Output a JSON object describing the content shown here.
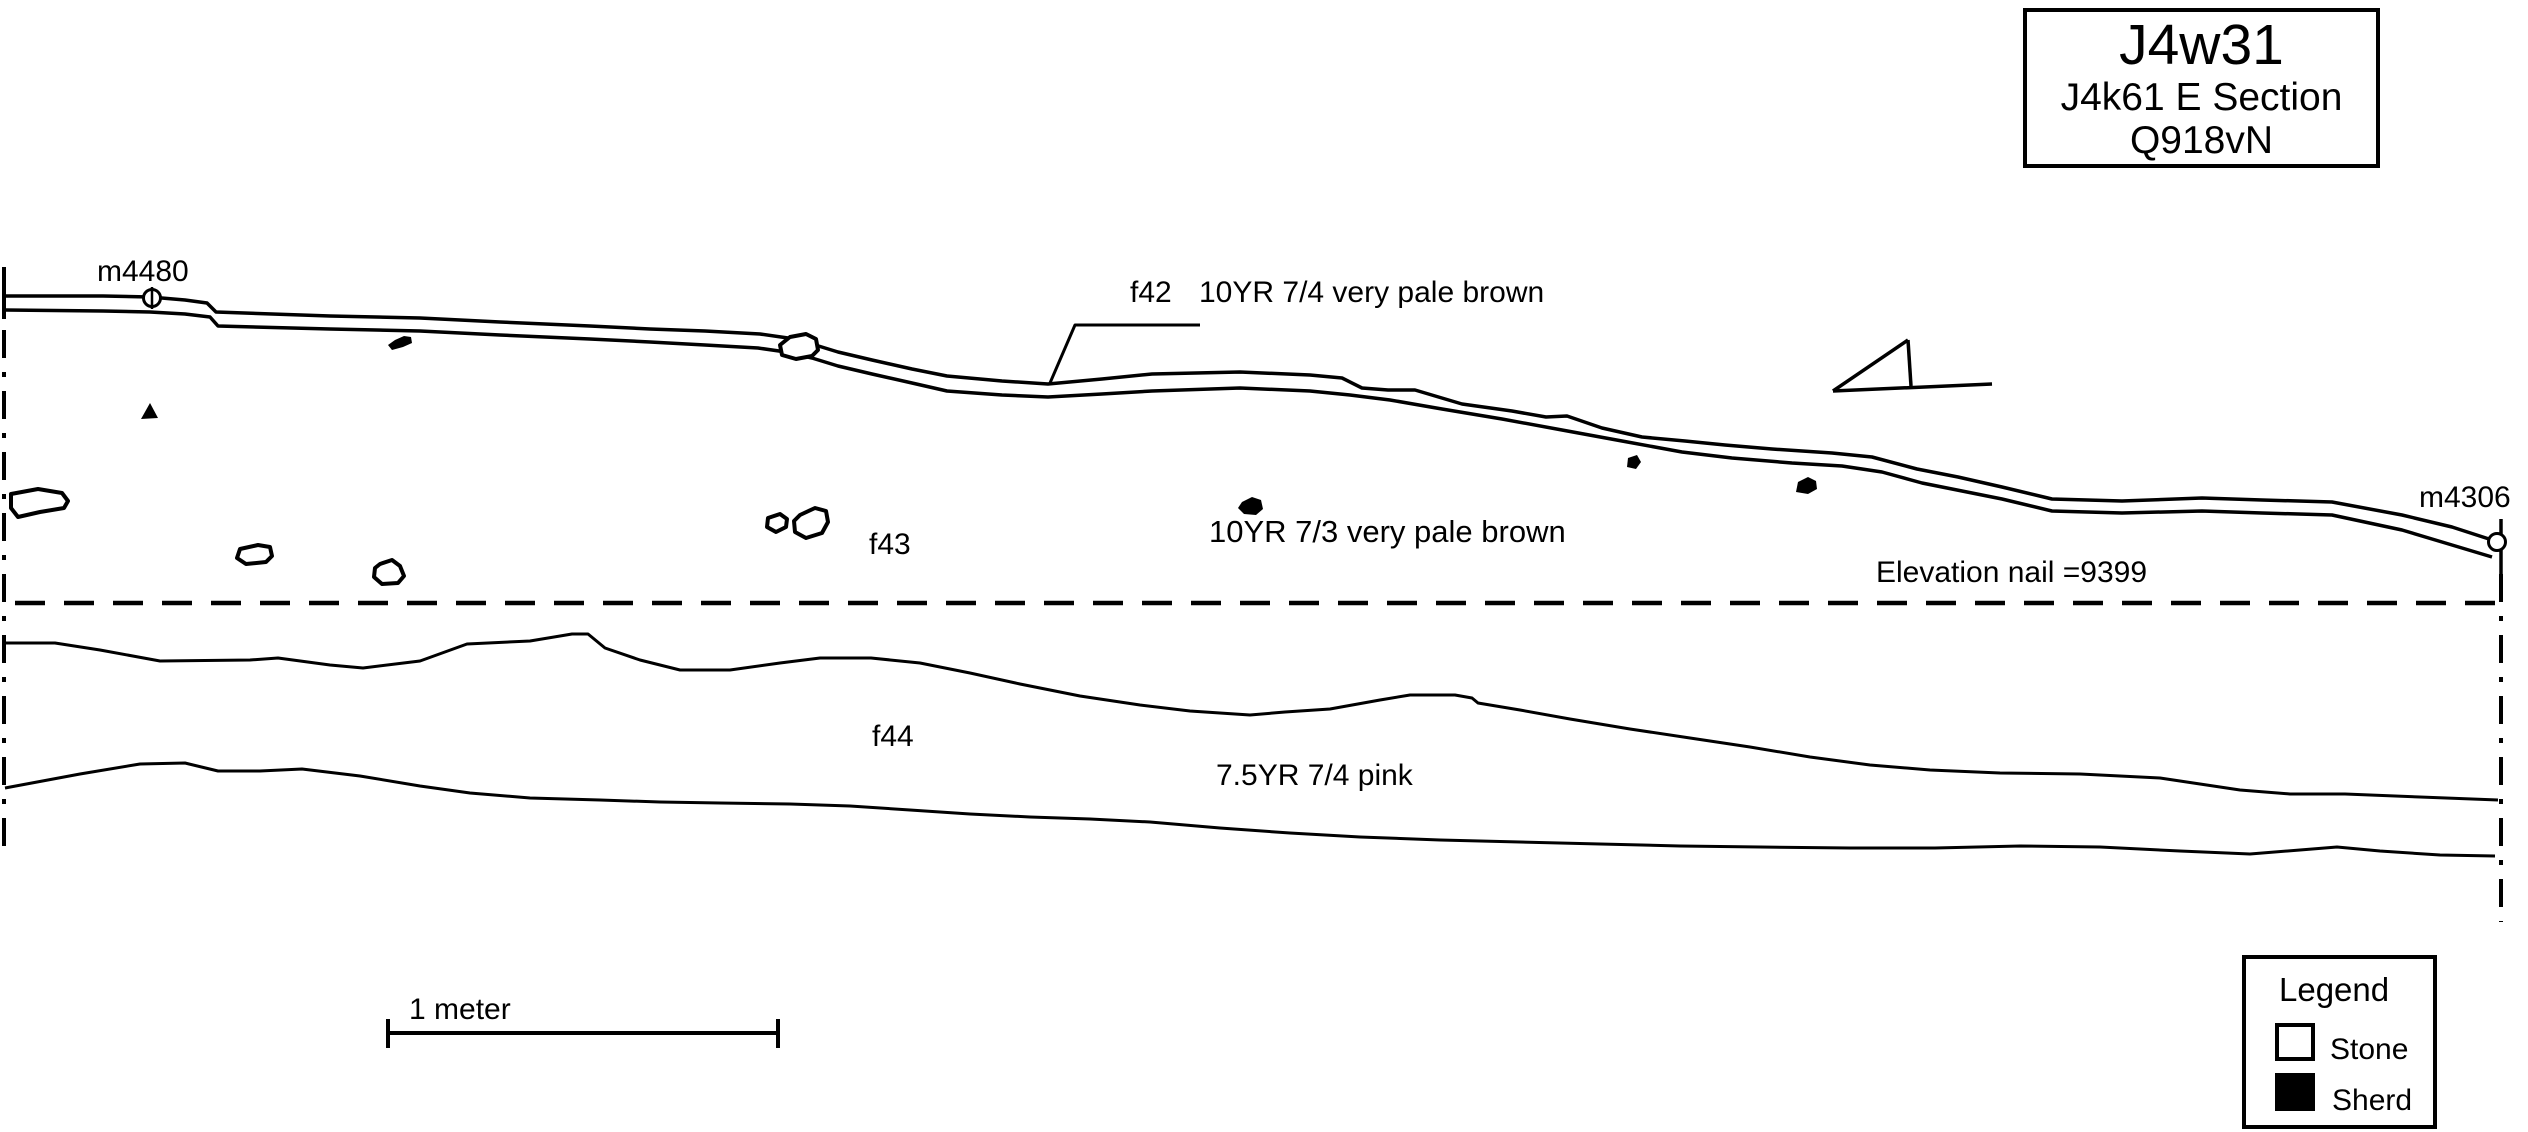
{
  "colors": {
    "ink": "#000000",
    "paper": "#ffffff"
  },
  "title_box": {
    "title": "J4w31",
    "line2": "J4k61 E Section",
    "line3": "Q918vN"
  },
  "nails": {
    "left_label": "m4480",
    "right_label": "m4306"
  },
  "features": {
    "f42": {
      "label": "f42",
      "munsell": "10YR 7/4 very pale brown"
    },
    "f43": {
      "label": "f43",
      "munsell": "10YR 7/3 very pale brown"
    },
    "f44": {
      "label": "f44",
      "munsell": "7.5YR 7/4 pink"
    }
  },
  "elevation_note": "Elevation nail =9399",
  "scale_bar": {
    "label": "1 meter"
  },
  "legend": {
    "title": "Legend",
    "items": [
      {
        "symbol": "stone-swatch",
        "label": "Stone"
      },
      {
        "symbol": "sherd-swatch",
        "label": "Sherd"
      }
    ]
  }
}
